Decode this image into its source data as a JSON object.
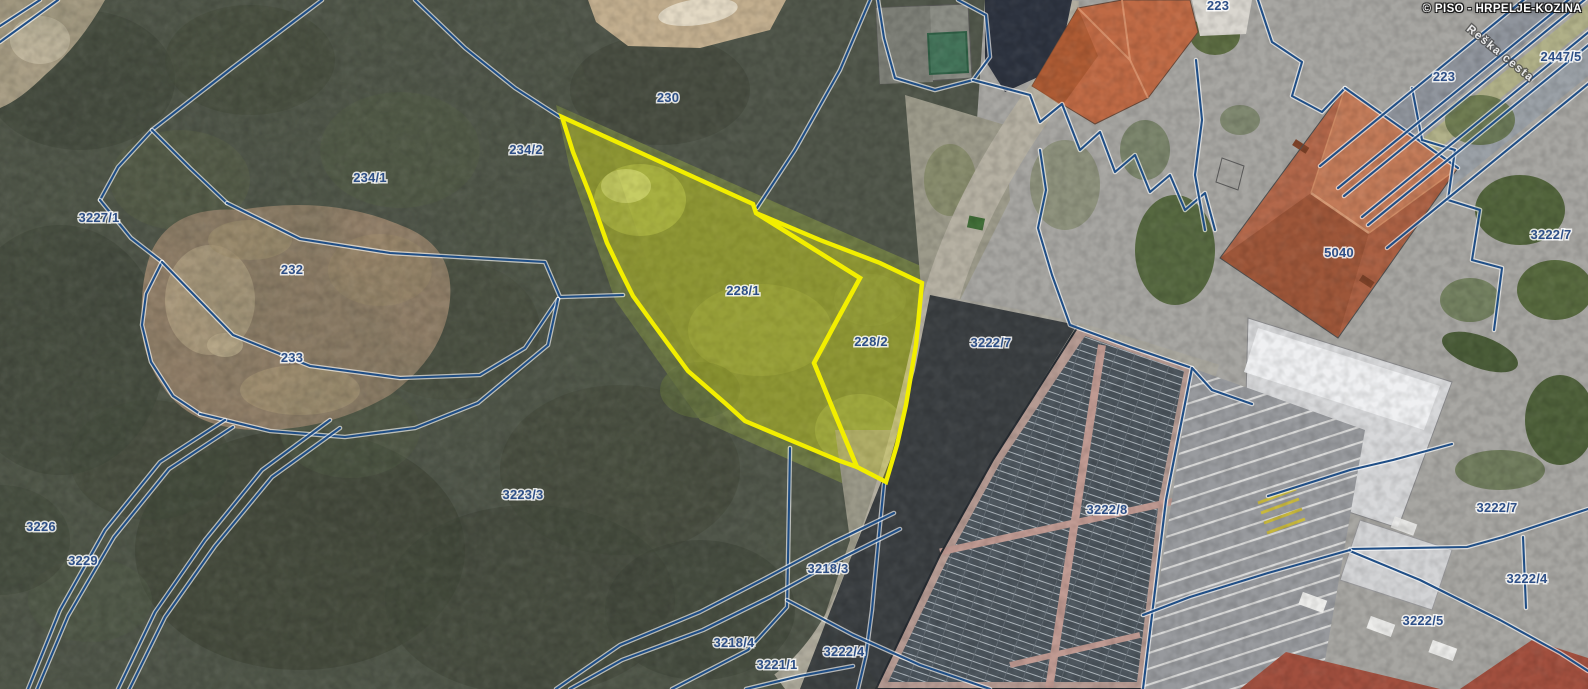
{
  "watermark": "© PISO - HRPELJE-KOZINA",
  "road_name": {
    "text": "Reška cesta",
    "x": 1466,
    "y": 30,
    "angle": 39
  },
  "selected_parcels": [
    {
      "id": "228/1",
      "points": "562,117 753,204 756,213 860,278 814,363 857,467 840,461 790,440 745,421 725,403 688,371 654,325 633,296 620,270 607,243 590,195 573,152"
    },
    {
      "id": "228/2",
      "points": "756,213 820,240 880,263 922,283 916,345 906,405 897,445 886,482 857,467 836,417 814,363 838,318 860,278"
    }
  ],
  "parcel_labels": [
    {
      "text": "230",
      "x": 668,
      "y": 98
    },
    {
      "text": "234/2",
      "x": 526,
      "y": 150
    },
    {
      "text": "234/1",
      "x": 370,
      "y": 178
    },
    {
      "text": "3227/1",
      "x": 99,
      "y": 218
    },
    {
      "text": "232",
      "x": 292,
      "y": 270
    },
    {
      "text": "233",
      "x": 292,
      "y": 358
    },
    {
      "text": "3226",
      "x": 41,
      "y": 527
    },
    {
      "text": "3229",
      "x": 83,
      "y": 561
    },
    {
      "text": "3223/3",
      "x": 523,
      "y": 495
    },
    {
      "text": "228/1",
      "x": 743,
      "y": 291
    },
    {
      "text": "228/2",
      "x": 871,
      "y": 342
    },
    {
      "text": "3222/7",
      "x": 991,
      "y": 343
    },
    {
      "text": "3218/3",
      "x": 828,
      "y": 569
    },
    {
      "text": "3218/4",
      "x": 734,
      "y": 643
    },
    {
      "text": "3221/1",
      "x": 777,
      "y": 665
    },
    {
      "text": "3222/4",
      "x": 844,
      "y": 652
    },
    {
      "text": "3222/8",
      "x": 1107,
      "y": 510
    },
    {
      "text": "5040",
      "x": 1339,
      "y": 253
    },
    {
      "text": "3222/7",
      "x": 1551,
      "y": 235
    },
    {
      "text": "223",
      "x": 1218,
      "y": 6
    },
    {
      "text": "2447/5",
      "x": 1561,
      "y": 57
    },
    {
      "text": "223",
      "x": 1444,
      "y": 77
    },
    {
      "text": "3222/7",
      "x": 1497,
      "y": 508
    },
    {
      "text": "3222/4",
      "x": 1527,
      "y": 579
    },
    {
      "text": "3222/5",
      "x": 1423,
      "y": 621
    }
  ],
  "boundary_lines": [
    "0,26 40,0",
    "0,42 58,0",
    "322,0 232,68 152,130 118,167 100,200",
    "100,200 131,238 162,262",
    "162,262 146,294 142,325 151,362 173,396 200,414",
    "152,130 190,168 227,203",
    "227,203 300,239 390,253 475,258 545,262 560,297 623,295",
    "162,262 233,335 310,366 400,378 480,375 525,348 558,299",
    "200,414 270,431 345,437 415,428 478,403 548,345 558,299",
    "28,689 60,610 105,530 160,462 225,420",
    "36,692 68,616 114,537 169,469 233,427",
    "118,689 155,612 205,540 262,470 330,420",
    "128,692 165,617 215,546 272,477 340,428",
    "415,0 465,48 515,88 560,117",
    "870,0 840,70 795,150 757,208",
    "884,484 878,545 872,610 866,655 858,689",
    "790,448 788,560 787,607 748,650 672,689",
    "787,600 853,635 920,665 990,689",
    "556,689 620,645 700,612 766,578 834,542 894,513",
    "570,689 622,660 703,630 770,597 840,559 900,529",
    "746,689 800,676 853,666",
    "878,0 884,38 895,78 935,90 973,80 990,57 986,15 958,0",
    "973,80 1030,95 1040,122 1062,104 1080,150 1100,132 1115,172 1135,155 1150,192 1170,175 1185,210 1205,193 1215,230",
    "1196,60 1202,120 1195,175 1205,230",
    "1040,150 1046,190 1038,228 1052,275 1070,325 1130,347 1192,368",
    "1252,404 1212,390 1192,368 1166,500 1143,689",
    "1258,0 1272,42 1302,62 1292,96 1322,112 1345,88",
    "1345,88 1458,168",
    "1412,88 1422,140 1455,150 1448,200 1480,210 1472,260 1502,268 1494,330",
    "1268,496 1350,470 1393,460 1452,444",
    "1350,549 1467,547 1503,537 1588,509",
    "1350,551 1420,580 1500,620 1560,653 1588,671",
    "1350,550 1268,573 1190,597 1143,615",
    "1523,537 1526,608"
  ],
  "road_edge_lines": [
    "1570,-38 1320,166",
    "1588,-16 1338,188",
    "1594,-8 1344,196",
    "1612,13 1362,217",
    "1618,21 1368,225",
    "1637,44 1387,248"
  ],
  "colors": {
    "line_blue": "#1f4e86",
    "line_casing": "rgba(255,255,255,0.62)",
    "highlight_stroke": "#f2ee00",
    "highlight_fill": "rgba(244,240,0,0.24)",
    "label_blue": "#2d4f87"
  }
}
